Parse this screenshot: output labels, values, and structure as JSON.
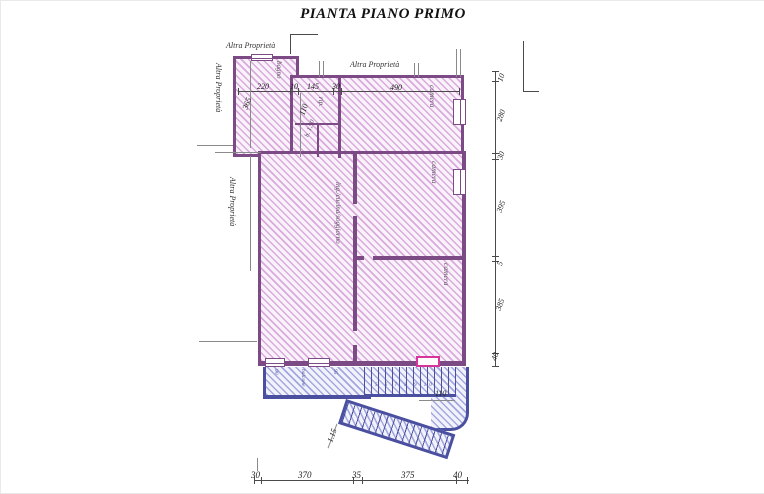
{
  "title": "PIANTA PIANO PRIMO",
  "labels": {
    "altra_top_left": "Altra Proprietà",
    "altra_left_upper": "Altra Proprietà",
    "altra_left_mid": "Altra Proprietà",
    "altra_top_center": "Altra Proprietà"
  },
  "rooms": {
    "bagno": "bagno",
    "rip": "rip.",
    "rip_height": "h. 1,90",
    "camera_top": "camera",
    "camera_mid": "camera",
    "camera_bottom": "camera",
    "living": "ing./cucina/soggiorno",
    "balcone": "balcone"
  },
  "dims": {
    "top": [
      "220",
      "10",
      "145",
      "30",
      "490"
    ],
    "left": [
      "365",
      "110"
    ],
    "right": [
      "10",
      "280",
      "30",
      "395",
      "5",
      "385",
      "40"
    ],
    "bottom": [
      "30",
      "370",
      "35",
      "375",
      "40"
    ],
    "stair": [
      "110",
      "1.15"
    ],
    "balcony_small": [
      "90",
      "95"
    ],
    "steps": "5 6 7 8 9 10"
  },
  "colors": {
    "wall_pink": "#7c4a85",
    "hatch_pink": "#d9aadc",
    "wall_blue": "#4a4fa0",
    "hatch_blue": "#a2a8de",
    "door_accent": "#d6359b",
    "dimension": "#222222"
  }
}
